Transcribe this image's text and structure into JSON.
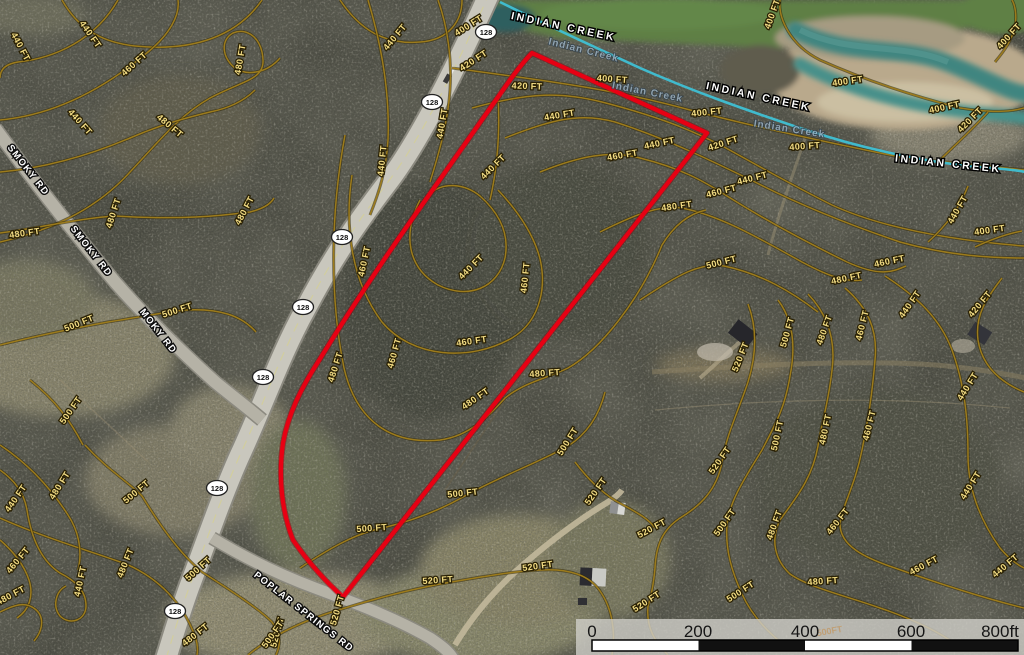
{
  "map": {
    "boundary_color": "#e80013",
    "contour_color": "#9c7b1c",
    "creek_color": "#3fc0d4",
    "contour_labels": [
      {
        "t": "440 FT",
        "x": 18,
        "y": 48,
        "r": 62
      },
      {
        "t": "440 FT",
        "x": 88,
        "y": 36,
        "r": 55
      },
      {
        "t": "460 FT",
        "x": 136,
        "y": 66,
        "r": -42
      },
      {
        "t": "480 FT",
        "x": 243,
        "y": 60,
        "r": -80
      },
      {
        "t": "440 FT",
        "x": 78,
        "y": 124,
        "r": 48
      },
      {
        "t": "480 FT",
        "x": 168,
        "y": 128,
        "r": 40
      },
      {
        "t": "480 FT",
        "x": 25,
        "y": 236,
        "r": -8
      },
      {
        "t": "480 FT",
        "x": 116,
        "y": 214,
        "r": -72
      },
      {
        "t": "480 FT",
        "x": 247,
        "y": 212,
        "r": -62
      },
      {
        "t": "500 FT",
        "x": 178,
        "y": 313,
        "r": -18
      },
      {
        "t": "500 FT",
        "x": 80,
        "y": 326,
        "r": -22
      },
      {
        "t": "400 FT",
        "x": 470,
        "y": 28,
        "r": -32
      },
      {
        "t": "420 FT",
        "x": 475,
        "y": 63,
        "r": -33
      },
      {
        "t": "440 FT",
        "x": 397,
        "y": 39,
        "r": -50
      },
      {
        "t": "440 FT",
        "x": 445,
        "y": 124,
        "r": -80
      },
      {
        "t": "440 FT",
        "x": 385,
        "y": 161,
        "r": -84
      },
      {
        "t": "440 FT",
        "x": 495,
        "y": 169,
        "r": -45
      },
      {
        "t": "420 FT",
        "x": 527,
        "y": 89,
        "r": 2
      },
      {
        "t": "400 FT",
        "x": 612,
        "y": 82,
        "r": 4
      },
      {
        "t": "440 FT",
        "x": 560,
        "y": 118,
        "r": -10
      },
      {
        "t": "440 FT",
        "x": 660,
        "y": 146,
        "r": -12
      },
      {
        "t": "460 FT",
        "x": 623,
        "y": 158,
        "r": -10
      },
      {
        "t": "480 FT",
        "x": 677,
        "y": 209,
        "r": -8
      },
      {
        "t": "500 FT",
        "x": 722,
        "y": 265,
        "r": -14
      },
      {
        "t": "400 FT",
        "x": 707,
        "y": 115,
        "r": -6
      },
      {
        "t": "420 FT",
        "x": 724,
        "y": 146,
        "r": -18
      },
      {
        "t": "440 FT",
        "x": 753,
        "y": 181,
        "r": -14
      },
      {
        "t": "460 FT",
        "x": 722,
        "y": 194,
        "r": -14
      },
      {
        "t": "400 FT",
        "x": 775,
        "y": 15,
        "r": -70
      },
      {
        "t": "400 FT",
        "x": 848,
        "y": 84,
        "r": -8
      },
      {
        "t": "400 FT",
        "x": 945,
        "y": 110,
        "r": -12
      },
      {
        "t": "400 FT",
        "x": 1011,
        "y": 38,
        "r": -48
      },
      {
        "t": "400 FT",
        "x": 805,
        "y": 149,
        "r": -4
      },
      {
        "t": "420 FT",
        "x": 972,
        "y": 122,
        "r": -45
      },
      {
        "t": "440 FT",
        "x": 960,
        "y": 211,
        "r": -60
      },
      {
        "t": "400 FT",
        "x": 990,
        "y": 233,
        "r": -8
      },
      {
        "t": "460 FT",
        "x": 890,
        "y": 264,
        "r": -12
      },
      {
        "t": "480 FT",
        "x": 847,
        "y": 281,
        "r": -12
      },
      {
        "t": "420 FT",
        "x": 982,
        "y": 306,
        "r": -50
      },
      {
        "t": "440 FT",
        "x": 912,
        "y": 306,
        "r": -55
      },
      {
        "t": "460 FT",
        "x": 865,
        "y": 326,
        "r": -76
      },
      {
        "t": "480 FT",
        "x": 827,
        "y": 331,
        "r": -70
      },
      {
        "t": "500 FT",
        "x": 790,
        "y": 333,
        "r": -74
      },
      {
        "t": "520 FT",
        "x": 743,
        "y": 358,
        "r": -68
      },
      {
        "t": "520 FT",
        "x": 722,
        "y": 462,
        "r": -55
      },
      {
        "t": "500 FT",
        "x": 780,
        "y": 436,
        "r": -78
      },
      {
        "t": "480 FT",
        "x": 828,
        "y": 430,
        "r": -78
      },
      {
        "t": "460 FT",
        "x": 872,
        "y": 426,
        "r": -76
      },
      {
        "t": "440 FT",
        "x": 970,
        "y": 388,
        "r": -58
      },
      {
        "t": "440 FT",
        "x": 973,
        "y": 487,
        "r": -58
      },
      {
        "t": "480 FT",
        "x": 777,
        "y": 526,
        "r": -70
      },
      {
        "t": "460 FT",
        "x": 840,
        "y": 523,
        "r": -52
      },
      {
        "t": "460 FT",
        "x": 925,
        "y": 568,
        "r": -28
      },
      {
        "t": "480 FT",
        "x": 823,
        "y": 584,
        "r": -4
      },
      {
        "t": "440 FT",
        "x": 1007,
        "y": 568,
        "r": -40
      },
      {
        "t": "500 FT",
        "x": 727,
        "y": 524,
        "r": -55
      },
      {
        "t": "500 FT",
        "x": 742,
        "y": 594,
        "r": -33
      },
      {
        "t": "460 FT",
        "x": 367,
        "y": 262,
        "r": -78
      },
      {
        "t": "440 FT",
        "x": 473,
        "y": 269,
        "r": -45
      },
      {
        "t": "460 FT",
        "x": 528,
        "y": 278,
        "r": -84
      },
      {
        "t": "460 FT",
        "x": 397,
        "y": 354,
        "r": -74
      },
      {
        "t": "460 FT",
        "x": 472,
        "y": 344,
        "r": -8
      },
      {
        "t": "480 FT",
        "x": 338,
        "y": 368,
        "r": -72
      },
      {
        "t": "480 FT",
        "x": 545,
        "y": 376,
        "r": -4
      },
      {
        "t": "480 FT",
        "x": 477,
        "y": 401,
        "r": -35
      },
      {
        "t": "500 FT",
        "x": 570,
        "y": 443,
        "r": -58
      },
      {
        "t": "500 FT",
        "x": 463,
        "y": 496,
        "r": -6
      },
      {
        "t": "500 FT",
        "x": 372,
        "y": 531,
        "r": -4
      },
      {
        "t": "520 FT",
        "x": 598,
        "y": 493,
        "r": -55
      },
      {
        "t": "520 FT",
        "x": 653,
        "y": 531,
        "r": -28
      },
      {
        "t": "520 FT",
        "x": 538,
        "y": 569,
        "r": -8
      },
      {
        "t": "520 FT",
        "x": 648,
        "y": 604,
        "r": -33
      },
      {
        "t": "520 FT",
        "x": 438,
        "y": 583,
        "r": -4
      },
      {
        "t": "520 FT",
        "x": 340,
        "y": 611,
        "r": -74
      },
      {
        "t": "520 FT",
        "x": 280,
        "y": 633,
        "r": -75
      },
      {
        "t": "500 FT",
        "x": 275,
        "y": 636,
        "r": -55
      },
      {
        "t": "500 FT",
        "x": 200,
        "y": 571,
        "r": -42
      },
      {
        "t": "480 FT",
        "x": 197,
        "y": 637,
        "r": -38
      },
      {
        "t": "480 FT",
        "x": 128,
        "y": 564,
        "r": -68
      },
      {
        "t": "500 FT",
        "x": 138,
        "y": 494,
        "r": -40
      },
      {
        "t": "500 FT",
        "x": 73,
        "y": 412,
        "r": -55
      },
      {
        "t": "480 FT",
        "x": 62,
        "y": 487,
        "r": -58
      },
      {
        "t": "440 FT",
        "x": 18,
        "y": 500,
        "r": -55
      },
      {
        "t": "460 FT",
        "x": 20,
        "y": 562,
        "r": -50
      },
      {
        "t": "440 FT",
        "x": 83,
        "y": 582,
        "r": -78
      },
      {
        "t": "480 FT",
        "x": 12,
        "y": 598,
        "r": -28
      }
    ],
    "road_labels": [
      {
        "t": "SMOKY RD",
        "x": 26,
        "y": 172,
        "r": 52
      },
      {
        "t": "SMOKY RD",
        "x": 89,
        "y": 253,
        "r": 52
      },
      {
        "t": "MOKY RD",
        "x": 156,
        "y": 333,
        "r": 52
      },
      {
        "t": "POPLAR SPRINGS RD",
        "x": 302,
        "y": 614,
        "r": 38
      }
    ],
    "creek_labels": [
      {
        "t": "INDIAN CREEK",
        "x": 563,
        "y": 30,
        "r": 12
      },
      {
        "t": "INDIAN CREEK",
        "x": 758,
        "y": 100,
        "r": 12
      },
      {
        "t": "INDIAN CREEK",
        "x": 948,
        "y": 167,
        "r": 6
      }
    ],
    "creek_labels_faded": [
      {
        "t": "Indian Creek",
        "x": 583,
        "y": 53,
        "r": 14
      },
      {
        "t": "Indian Creek",
        "x": 647,
        "y": 95,
        "r": 11
      },
      {
        "t": "Indian Creek",
        "x": 789,
        "y": 132,
        "r": 9
      }
    ],
    "route_shields": [
      {
        "label": "128",
        "x": 486,
        "y": 32
      },
      {
        "label": "128",
        "x": 432,
        "y": 102
      },
      {
        "label": "128",
        "x": 342,
        "y": 237
      },
      {
        "label": "128",
        "x": 303,
        "y": 307
      },
      {
        "label": "128",
        "x": 263,
        "y": 377
      },
      {
        "label": "128",
        "x": 217,
        "y": 488
      },
      {
        "label": "128",
        "x": 175,
        "y": 611
      }
    ]
  },
  "scale_bar": {
    "ticks": [
      "0",
      "200",
      "400",
      "600"
    ],
    "end_label": "800ft",
    "ghost_label": "500FT"
  }
}
